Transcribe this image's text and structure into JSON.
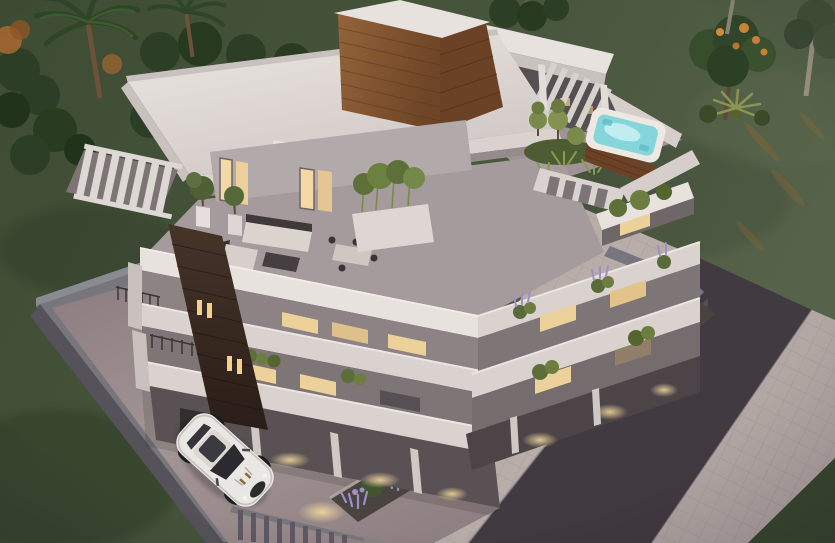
{
  "meta": {
    "type": "3d-architectural-exterior-render",
    "view": "aerial-three-quarter",
    "time_of_day": "dusk",
    "style": "modern-white-flat-roof-apartment-building"
  },
  "colors": {
    "lawn": "#46543a",
    "lawn_dark": "#394830",
    "lawn_light": "#55624a",
    "white_top": "#e8e2de",
    "white_face": "#d9d2ce",
    "white_dim": "#c8c1be",
    "shadow_face": "#8d8385",
    "recess": "#7e7577",
    "interior": "#575052",
    "wood_light": "#8a5a33",
    "wood_mid": "#6b4226",
    "wood_dark": "#37291f",
    "water": "#85d6da",
    "water_light": "#c6f0f2",
    "road": "#4a4349",
    "sidewalk": "#b3a7a4",
    "pavement": "#b9adaa",
    "driveway": "#9a8c8d",
    "wall": "#77767c",
    "wall_dark": "#55525a",
    "foliage": "#42552e",
    "foliage_dark": "#2c3e25",
    "foliage_light": "#6d7d40",
    "lavender": "#9d90c4",
    "window": "#ecd19b",
    "glow": "#e7cb8f",
    "uplight": "#dfe584",
    "car": "#e9e7e3",
    "trunk": "#6b5239",
    "soil": "#4a4440"
  },
  "scene": {
    "building": {
      "visible_floors": 3,
      "roof": [
        "large-white-flat-roof",
        "wood-clad-rooftop-box",
        "slatted-pergola-sections"
      ],
      "amenities": [
        "rooftop-jacuzzi",
        "roof-terrace-lounge",
        "outdoor-dining",
        "planted-balconies"
      ]
    },
    "objects": [
      "white-sports-car",
      "driveway",
      "perimeter-walls",
      "entry-fence",
      "lavender-garden-beds",
      "garden-uplights",
      "entrance-walkway-lights",
      "asphalt-road",
      "sidewalks",
      "lawn",
      "palm-trees",
      "flowering-tree",
      "shrub-clusters",
      "topiary-shrubs",
      "bamboo-planter",
      "sofa-set",
      "coffee-table",
      "dining-set",
      "potted-trees",
      "wood-stair-tower"
    ]
  }
}
